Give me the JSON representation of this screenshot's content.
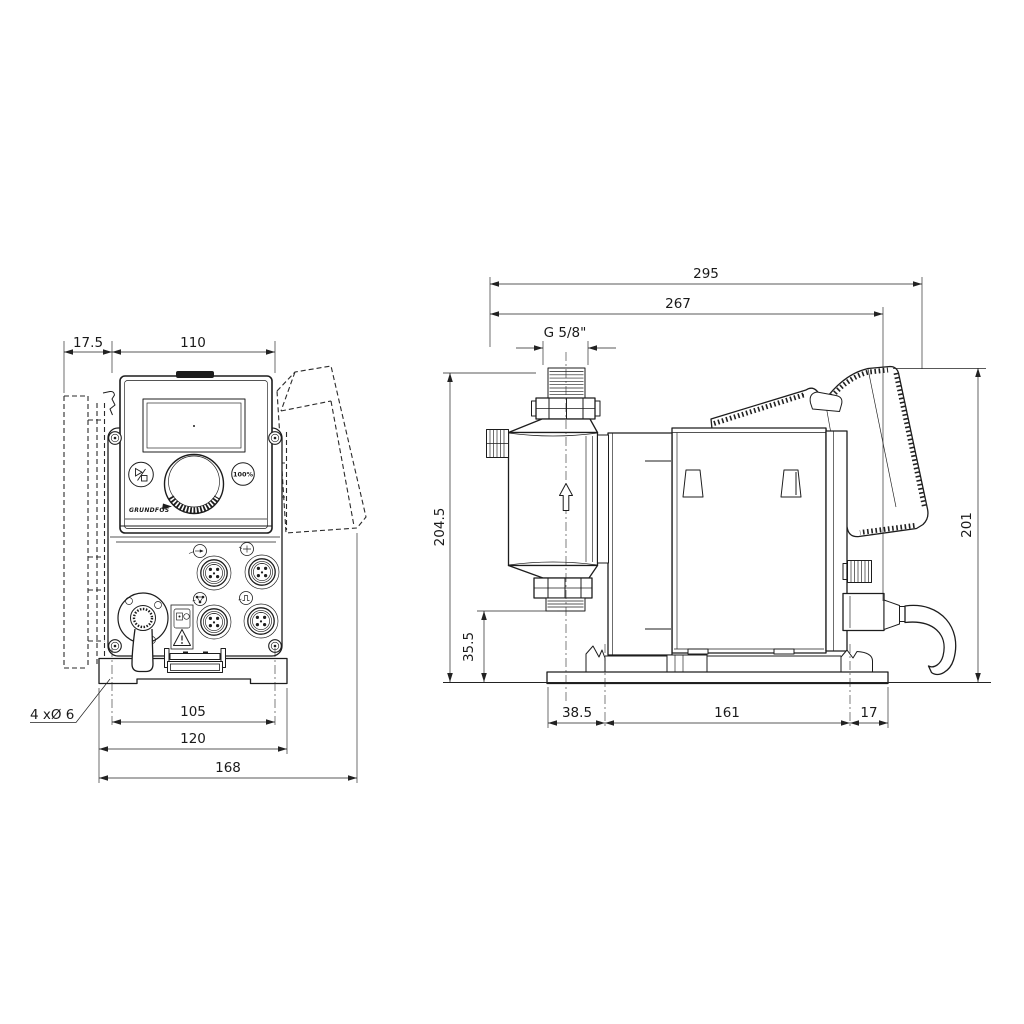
{
  "front_view": {
    "dimensions": {
      "bracket_offset": "17.5",
      "housing_width": "110",
      "mounting_hole_spacing": "105",
      "base_plate_width": "120",
      "overall_width": "168"
    },
    "mounting_hole_note": "4 xØ 6",
    "control_panel": {
      "full_capacity_key": "100%",
      "brand_logo": "GRUNDFOS"
    }
  },
  "side_view": {
    "dimensions": {
      "overall_depth": "295",
      "depth_to_connector": "267",
      "connection_thread": "G 5/8\"",
      "overall_height": "204.5",
      "valve_height": "35.5",
      "base_front_offset": "38.5",
      "base_hole_spacing": "161",
      "base_rear_offset": "17",
      "height_over_base": "201"
    }
  },
  "colors": {
    "line": "#1d1d1d",
    "background": "#ffffff"
  }
}
